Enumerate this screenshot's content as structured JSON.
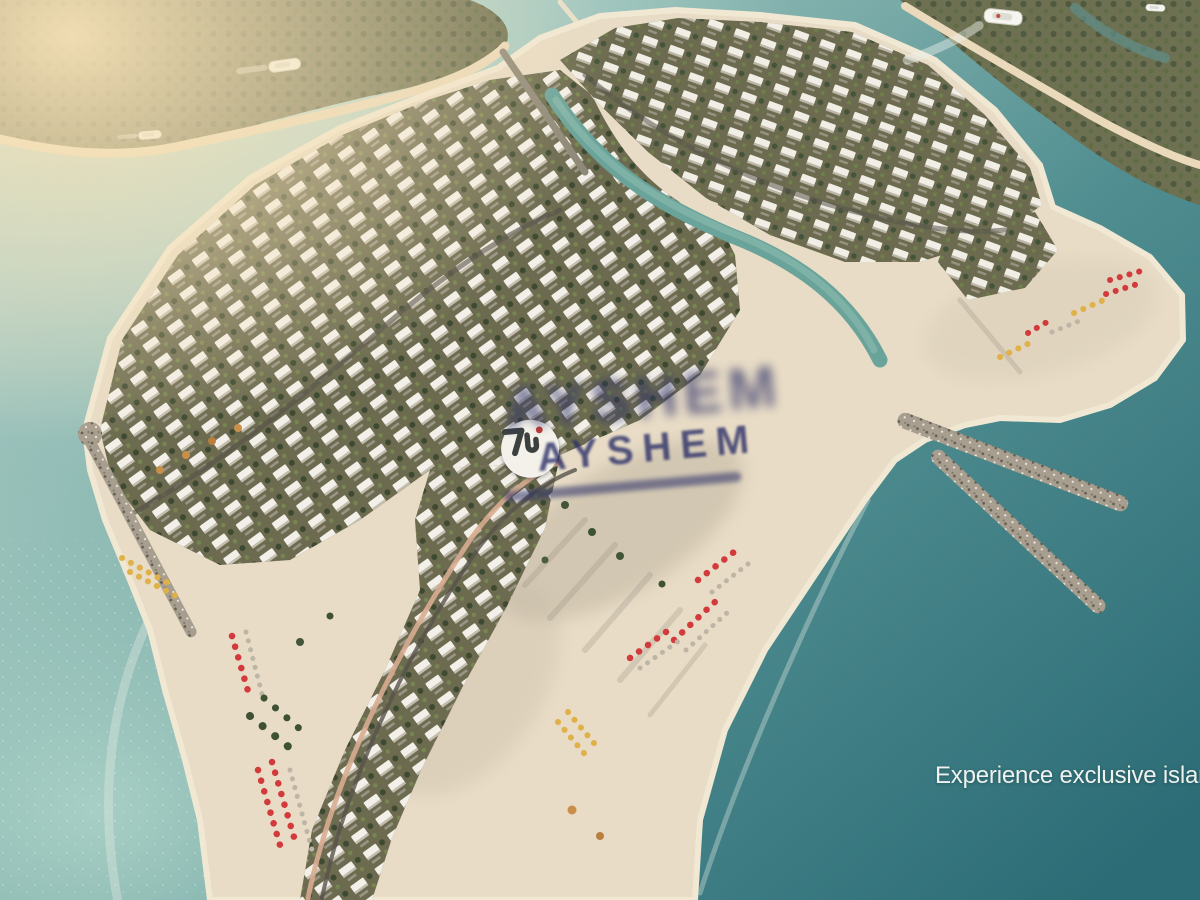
{
  "watermark": {
    "brand": "AYSHEM",
    "logo_icon": "monogram-7u-with-red-dot"
  },
  "tagline": {
    "text": "Experience exclusive island"
  },
  "scene": {
    "boats_visible": 4,
    "beach_furniture_colors": [
      "red umbrellas",
      "yellow loungers",
      "white loungers"
    ]
  },
  "colors": {
    "c-water-deep": "#2c6c76",
    "c-water-mid": "#4f8d90",
    "c-water-lagoon": "#b9d8cf",
    "c-water-shallow": "#a9cfc4",
    "c-sand": "#e8dcc6",
    "c-sand-rim": "#f1e8d4",
    "c-sand-shadow": "#b6ab97",
    "c-veg": "#6e7052",
    "c-veg-dark": "#3d4a31",
    "c-villa-base": "#6c6b50",
    "c-roof": "#f3f0e9",
    "c-road": "#57534b",
    "c-road-salmon": "#d8ac90",
    "c-canal": "#6aa39a",
    "c-canal-hi": "#84b5aa",
    "c-rock": "#a79e8f",
    "c-red": "#d23a3c",
    "c-yellow": "#dfb148",
    "c-lounger": "#bdb5a5",
    "c-palm": "#3f5134",
    "c-shore": "#ead9ba",
    "c-haze": "#f7e2b7",
    "c-navy": "#2b2f68",
    "c-tagline": "#eef2ef"
  }
}
